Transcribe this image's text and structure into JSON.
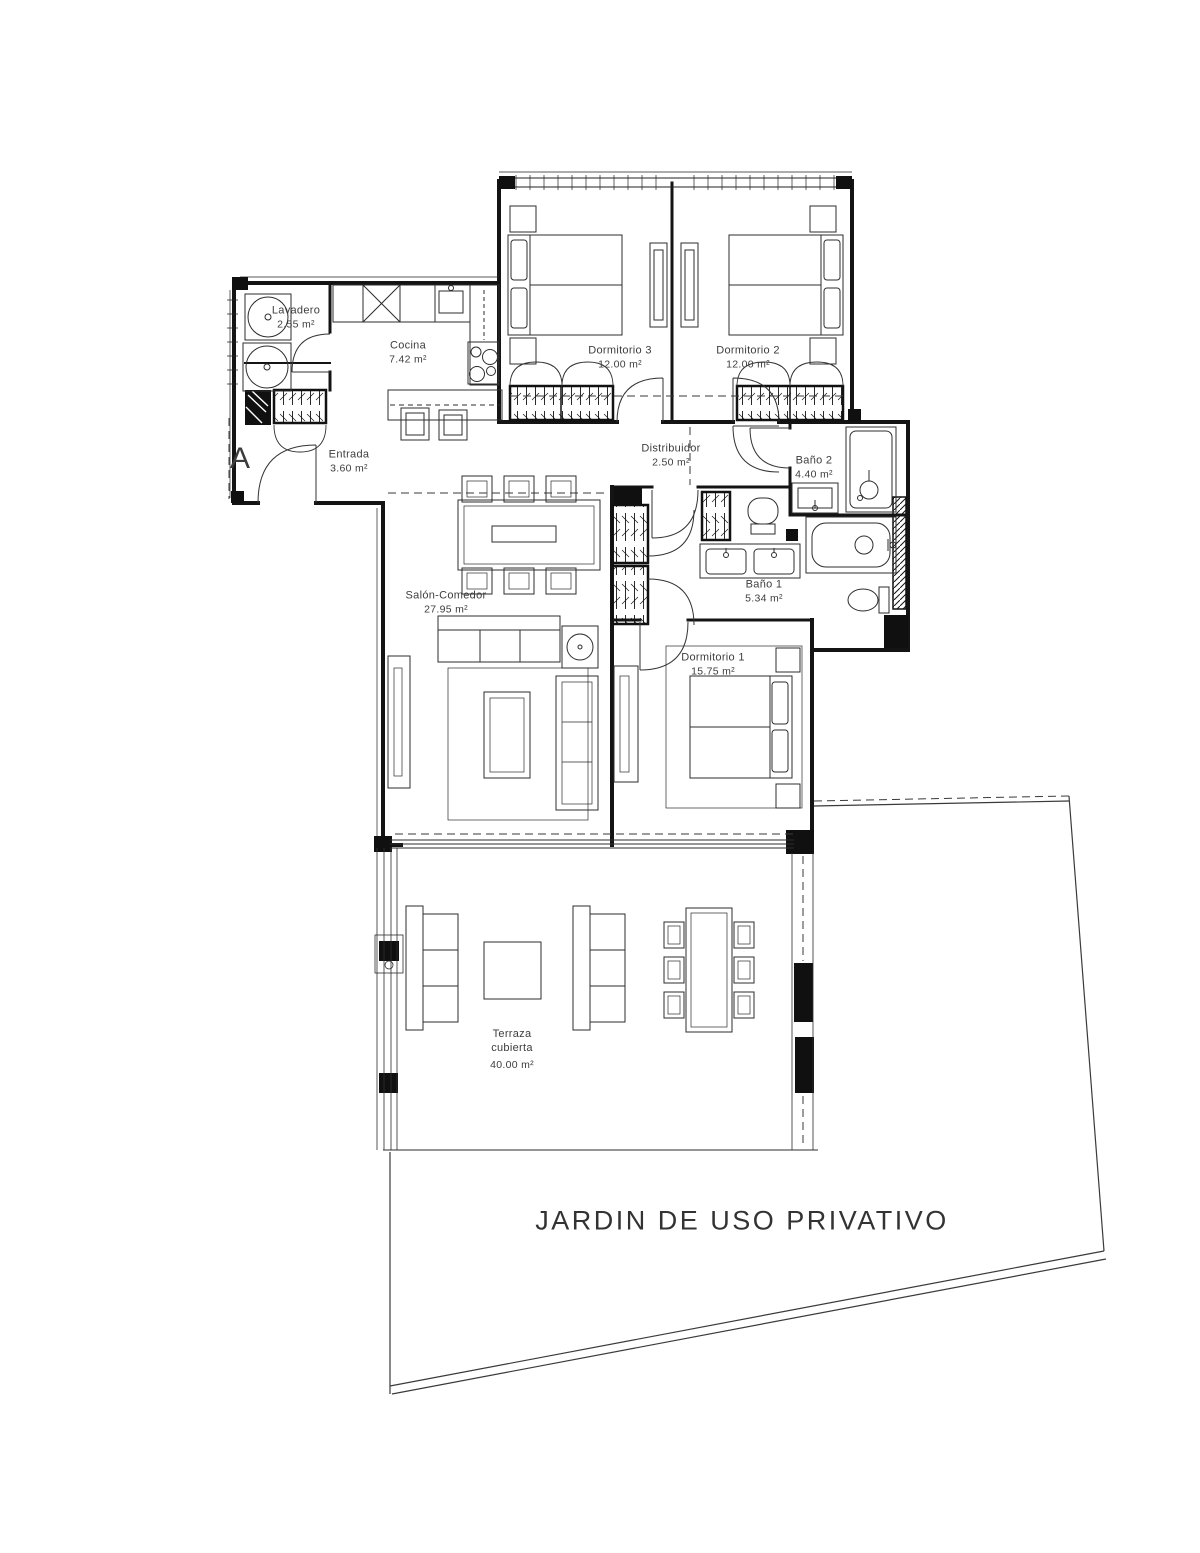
{
  "plan": {
    "section_marker": "A",
    "garden_label": "JARDIN DE USO PRIVATIVO",
    "rooms": [
      {
        "id": "lavadero",
        "label": "Lavadero",
        "area": "2.55 m²"
      },
      {
        "id": "cocina",
        "label": "Cocina",
        "area": "7.42 m²"
      },
      {
        "id": "entrada",
        "label": "Entrada",
        "area": "3.60 m²"
      },
      {
        "id": "dormitorio-3",
        "label": "Dormitorio 3",
        "area": "12.00 m²"
      },
      {
        "id": "dormitorio-2",
        "label": "Dormitorio 2",
        "area": "12.00 m²"
      },
      {
        "id": "distribuidor",
        "label": "Distribuidor",
        "area": "2.50 m²"
      },
      {
        "id": "bano-2",
        "label": "Baño 2",
        "area": "4.40 m²"
      },
      {
        "id": "salon-comedor",
        "label": "Salón-Comedor",
        "area": "27.95 m²"
      },
      {
        "id": "bano-1",
        "label": "Baño 1",
        "area": "5.34 m²"
      },
      {
        "id": "dormitorio-1",
        "label": "Dormitorio 1",
        "area": "15.75 m²"
      },
      {
        "id": "terraza",
        "label": "Terraza",
        "label2": "cubierta",
        "area": "40.00 m²"
      }
    ],
    "colors": {
      "line": "#1b1b1b",
      "text": "#3d3d3d"
    }
  }
}
